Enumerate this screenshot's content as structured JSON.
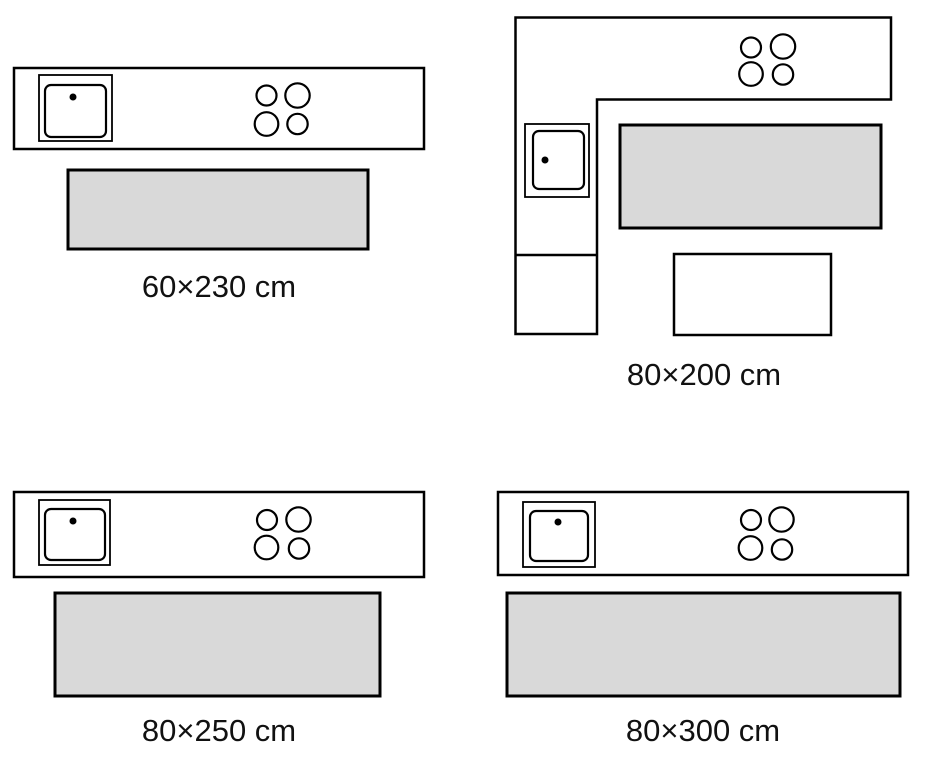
{
  "colors": {
    "background": "#ffffff",
    "line": "#000000",
    "rug_fill": "#d9d9d9",
    "text": "#111111"
  },
  "figures": [
    {
      "id": "straight-kitchen-rug-60x230",
      "layout": "straight-counter",
      "label": "60×230 cm",
      "parts": [
        "kitchen-counter",
        "sink-icon",
        "hob-burners-icon",
        "rug"
      ]
    },
    {
      "id": "l-shaped-kitchen-rug-80x200",
      "layout": "l-shaped-counter-with-table",
      "label": "80×200 cm",
      "parts": [
        "kitchen-counter",
        "sink-icon",
        "hob-burners-icon",
        "rug",
        "table"
      ]
    },
    {
      "id": "straight-kitchen-rug-80x250",
      "layout": "straight-counter",
      "label": "80×250 cm",
      "parts": [
        "kitchen-counter",
        "sink-icon",
        "hob-burners-icon",
        "rug"
      ]
    },
    {
      "id": "straight-kitchen-rug-80x300",
      "layout": "straight-counter",
      "label": "80×300 cm",
      "parts": [
        "kitchen-counter",
        "sink-icon",
        "hob-burners-icon",
        "rug"
      ]
    }
  ]
}
